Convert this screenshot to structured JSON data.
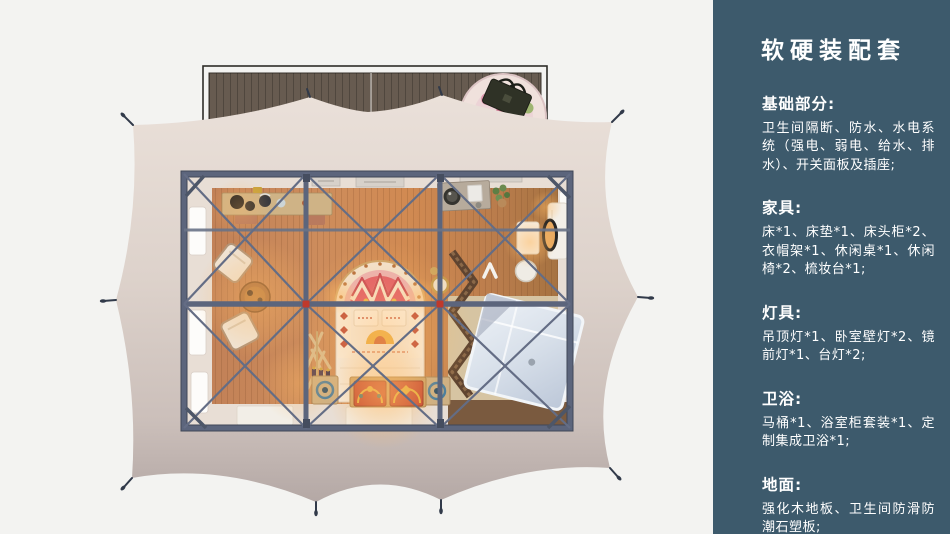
{
  "colors": {
    "sidebar_bg": "#3d5a6c",
    "sidebar_text": "#ffffff",
    "canvas_bg": "#f3f3f1",
    "canopy": "#e3d8d1",
    "frame_steel": "#5c657c",
    "hub_connector_red": "#c0392b",
    "floor_wood": "#c98a58"
  },
  "sidebar": {
    "title": "软硬装配套",
    "sections": [
      {
        "heading": "基础部分:",
        "body": "卫生间隔断、防水、水电系统（强电、弱电、给水、排水）、开关面板及插座;"
      },
      {
        "heading": "家具:",
        "body": "床*1、床垫*1、床头柜*2、衣帽架*1、休闲桌*1、休闲椅*2、梳妆台*1;"
      },
      {
        "heading": "灯具:",
        "body": "吊顶灯*1、卧室壁灯*2、镜前灯*1、台灯*2;"
      },
      {
        "heading": "卫浴:",
        "body": "马桶*1、浴室柜套装*1、定制集成卫浴*1;"
      },
      {
        "heading": "地面:",
        "body": "强化木地板、卫生间防滑防潮石塑板;"
      }
    ]
  }
}
